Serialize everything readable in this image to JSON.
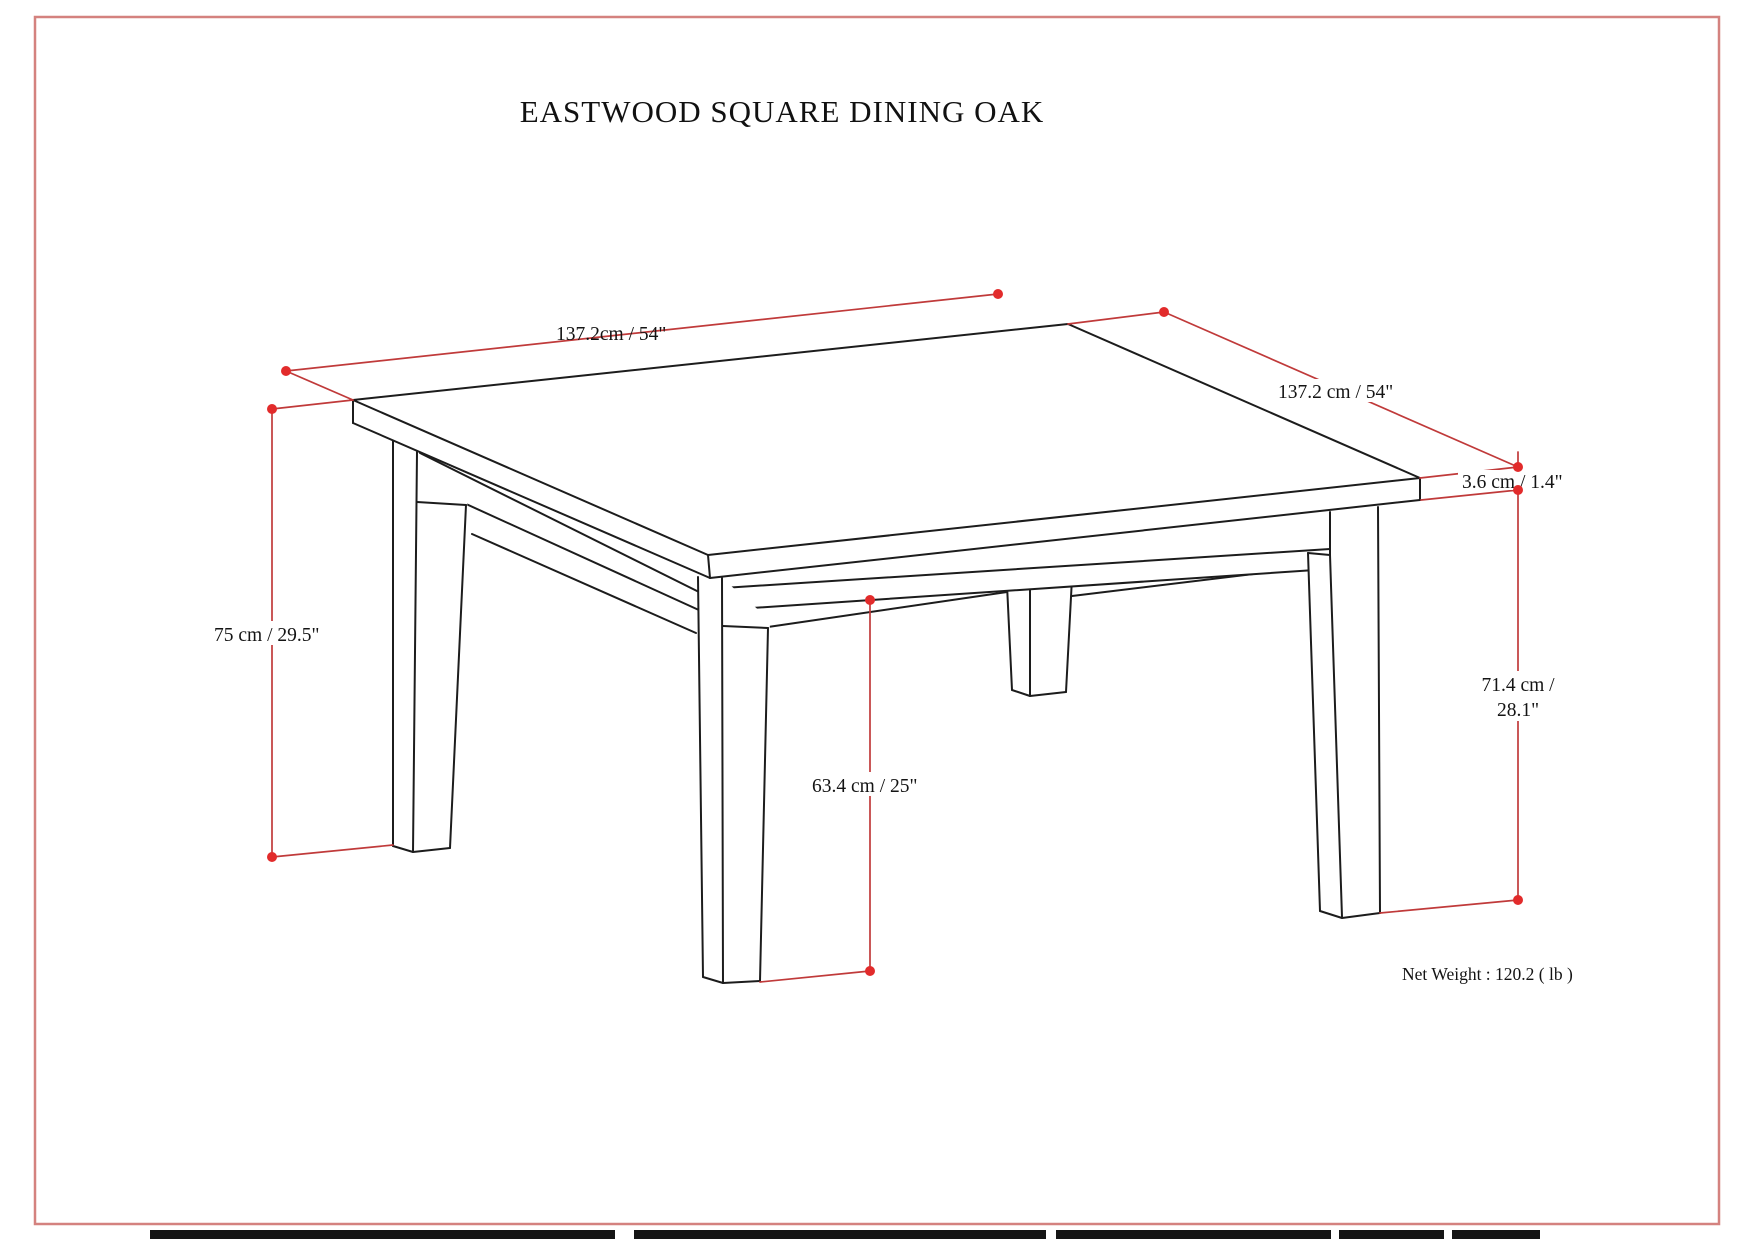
{
  "page": {
    "title": "EASTWOOD SQUARE DINING OAK",
    "net_weight": "Net Weight : 120.2 ( lb )"
  },
  "diagram": {
    "labels": {
      "top_length": "137.2cm / 54\"",
      "side_length": "137.2 cm / 54\"",
      "top_thickness": "3.6 cm / 1.4\"",
      "overall_height": "75 cm / 29.5\"",
      "leg_height_line1": "71.4 cm /",
      "leg_height_line2": "28.1\"",
      "floor_clearance": "63.4 cm / 25\""
    },
    "colors": {
      "dimension_line": "#c03a3a",
      "dimension_dot": "#e22b2b",
      "drawing_line": "#1c1c1c",
      "page_border": "#d4827f",
      "background": "#ffffff"
    }
  }
}
